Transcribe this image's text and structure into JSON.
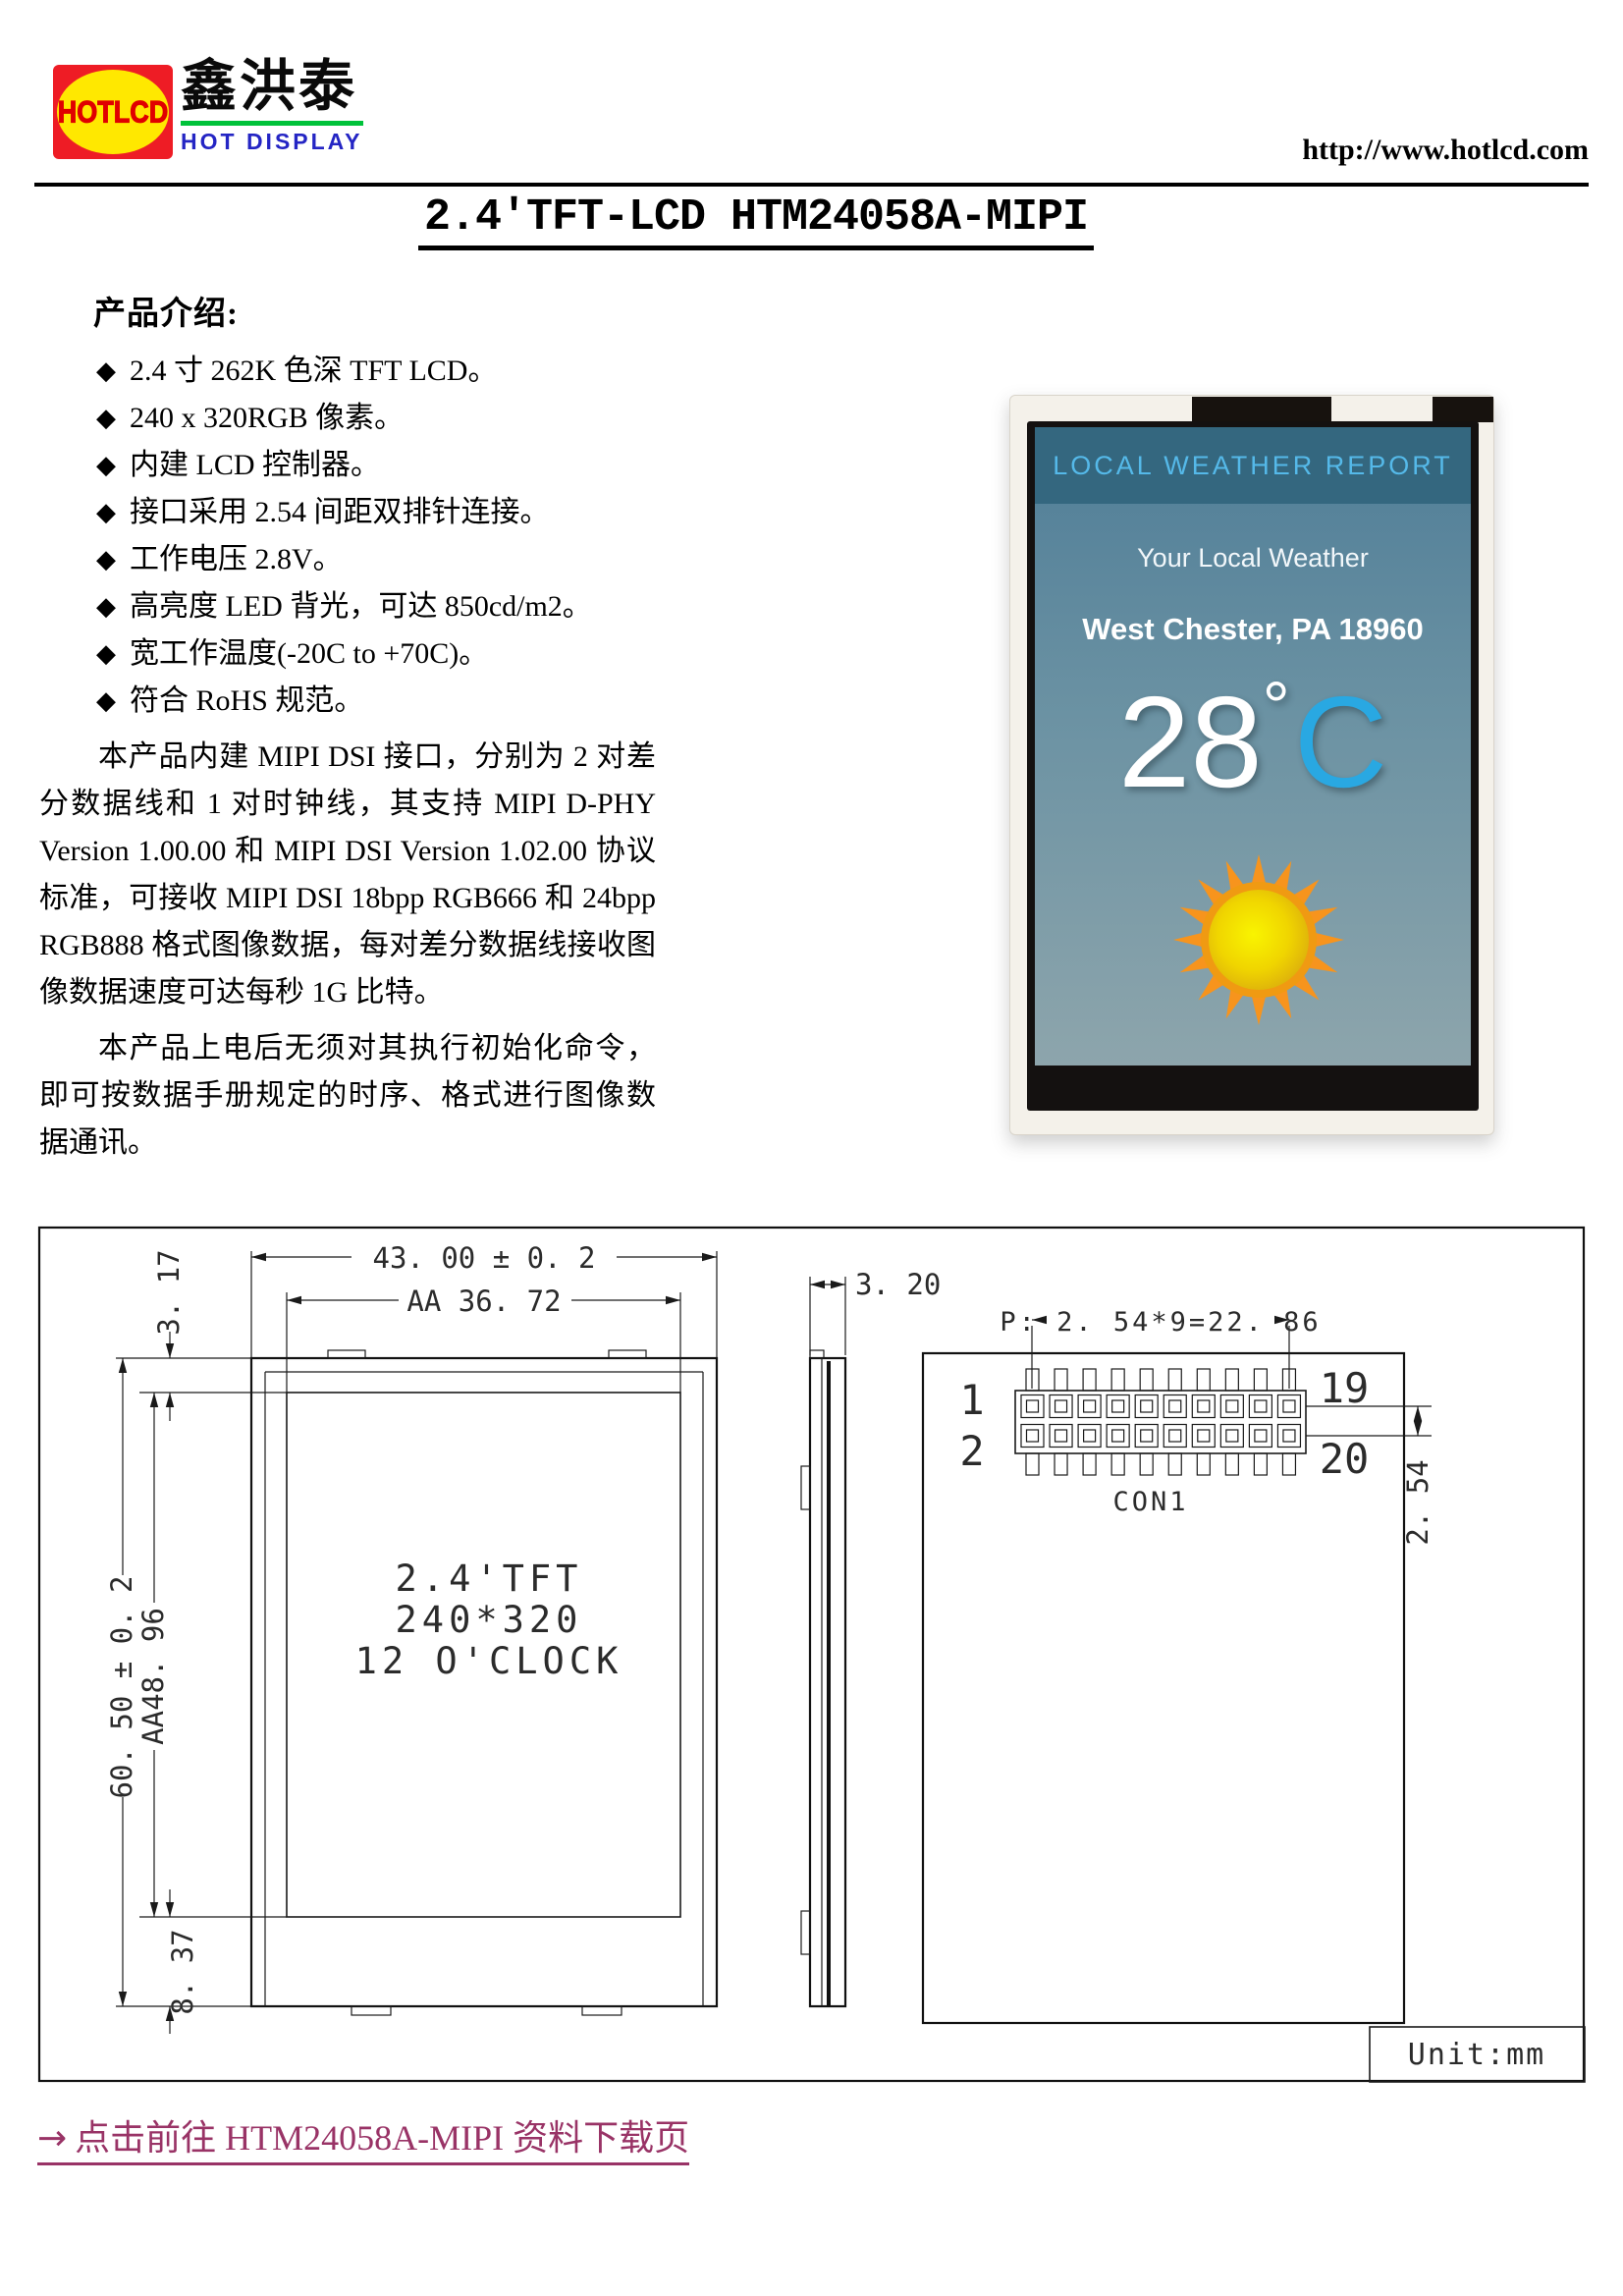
{
  "header": {
    "logo_mark": "HOTLCD",
    "logo_cn": "鑫洪泰",
    "logo_sub": "HOT DISPLAY",
    "url": "http://www.hotlcd.com"
  },
  "title": "2.4'TFT-LCD HTM24058A-MIPI",
  "intro": {
    "heading": "产品介绍:",
    "bullet_glyph": "◆",
    "bullets": [
      "2.4 寸 262K 色深 TFT LCD。",
      "240 x 320RGB 像素。",
      "内建 LCD 控制器。",
      "接口采用 2.54 间距双排针连接。",
      "工作电压 2.8V。",
      "高亮度 LED 背光，可达 850cd/m2。",
      "宽工作温度(-20C to +70C)。",
      "符合 RoHS 规范。"
    ],
    "para1": "本产品内建 MIPI DSI 接口，分别为 2 对差分数据线和 1 对时钟线，其支持 MIPI D-PHY Version 1.00.00 和 MIPI DSI Version 1.02.00 协议标准，可接收 MIPI DSI 18bpp RGB666 和 24bpp RGB888 格式图像数据，每对差分数据线接收图像数据速度可达每秒 1G 比特。",
    "para2": "本产品上电后无须对其执行初始化命令，即可按数据手册规定的时序、格式进行图像数据通讯。"
  },
  "photo": {
    "screen_header": "LOCAL WEATHER REPORT",
    "subtitle": "Your Local Weather",
    "location": "West Chester, PA 18960",
    "temp_value": "28",
    "temp_degree": "°",
    "temp_unit": "C"
  },
  "drawing": {
    "dim_total_width": "43. 00 ± 0. 2",
    "dim_aa_width": "AA 36. 72",
    "dim_top_margin": "3. 17",
    "dim_total_height": "60. 50 ± 0. 2",
    "dim_aa_height": "AA48. 96",
    "dim_bottom_margin": "8. 37",
    "dim_thickness": "3. 20",
    "dim_pitch": "P: 2. 54*9=22. 86",
    "dim_row_pitch": "2. 54",
    "pin_first_top": "1",
    "pin_first_bottom": "2",
    "pin_last_top": "19",
    "pin_last_bottom": "20",
    "connector_label": "CON1",
    "panel_line1": "2.4'TFT",
    "panel_line2": "240*320",
    "panel_line3": "12 O'CLOCK",
    "unit_note": "Unit:mm"
  },
  "footer": {
    "arrow": "→",
    "link_text": "点击前往 HTM24058A-MIPI 资料下载页"
  },
  "colors": {
    "link_purple": "#993366",
    "logo_red": "#ee1c25",
    "logo_yellow": "#ffe800",
    "logo_green": "#00c23a",
    "logo_blue": "#2425c4",
    "screen_cyan": "#29a8e2",
    "screen_header_bg": "#34677f"
  }
}
